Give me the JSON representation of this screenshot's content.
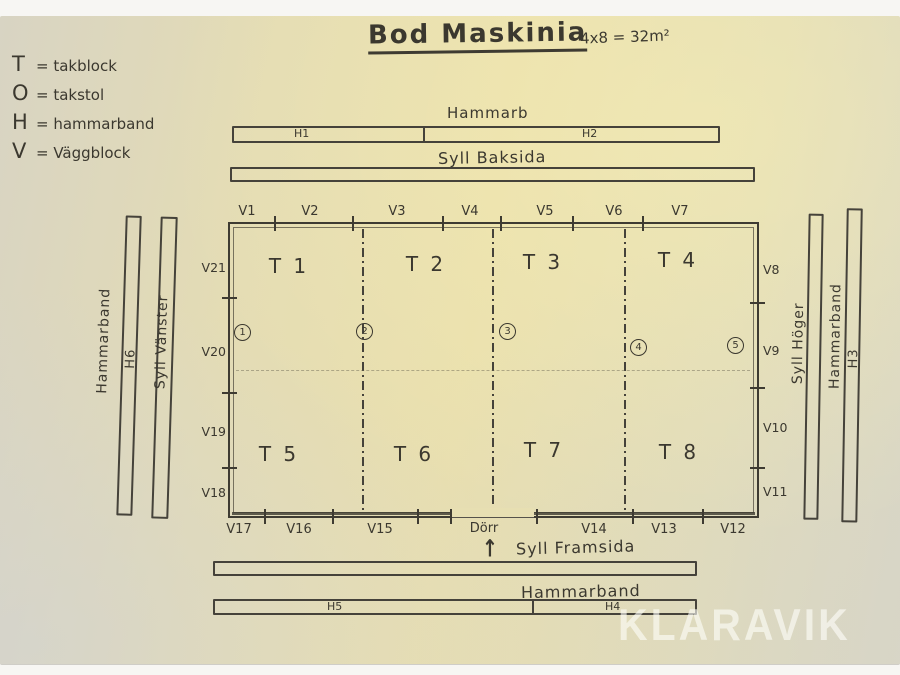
{
  "title": {
    "main": "Bod Maskinia",
    "dimensions": "4x8 = 32m²"
  },
  "legend": {
    "items": [
      {
        "symbol": "T",
        "rest": "= takblock"
      },
      {
        "symbol": "O",
        "rest": "= takstol"
      },
      {
        "symbol": "H",
        "rest": "= hammarband"
      },
      {
        "symbol": "V",
        "rest": "= Väggblock"
      }
    ]
  },
  "top_assembly": {
    "hammarband_label": "Hammarb",
    "segments": {
      "h1": "H1",
      "h2": "H2"
    },
    "syll_label": "Syll Baksida"
  },
  "left_assembly": {
    "hammarband_label": "Hammarband",
    "segment": "H6",
    "syll_label": "Syll Vänster"
  },
  "right_assembly": {
    "syll_label": "Syll Höger",
    "hammarband_label": "Hammarband",
    "segment": "H3"
  },
  "bottom_assembly": {
    "syll_label": "Syll Framsida",
    "hammarband_label": "Hammarband",
    "segments": {
      "h5": "H5",
      "h4": "H4"
    }
  },
  "floor_plan": {
    "top_wall": [
      "V1",
      "V2",
      "V3",
      "V4",
      "V5",
      "V6",
      "V7"
    ],
    "right_wall": [
      "V8",
      "V9",
      "V10",
      "V11"
    ],
    "bottom_wall": [
      "V17",
      "V16",
      "V15",
      "V14",
      "V13",
      "V12"
    ],
    "left_wall": [
      "V21",
      "V20",
      "V19",
      "V18"
    ],
    "door_label": "Dörr",
    "door_arrow": "↑",
    "roof_blocks_front": [
      "T 1",
      "T 2",
      "T 3",
      "T 4"
    ],
    "roof_blocks_back": [
      "T 5",
      "T 6",
      "T 7",
      "T 8"
    ],
    "truss_positions": [
      "1",
      "2",
      "3",
      "4",
      "5"
    ]
  },
  "watermark": "KLARAVIK"
}
